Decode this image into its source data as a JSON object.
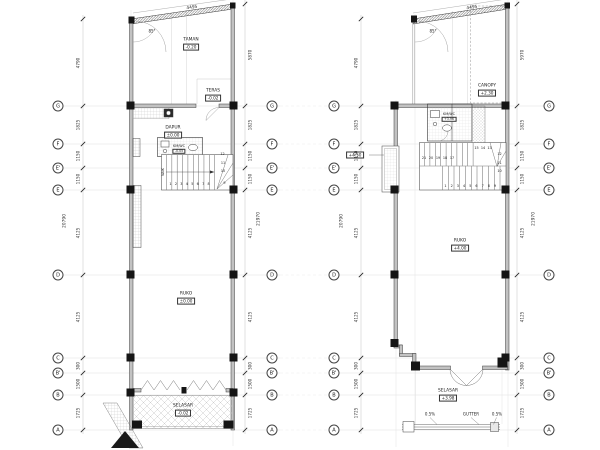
{
  "drawing": {
    "grid_letters": [
      "G",
      "F",
      "E'",
      "E",
      "D",
      "C",
      "B'",
      "B",
      "A"
    ],
    "plans": [
      {
        "name": "lower-floor-plan",
        "rooms": {
          "taman": {
            "name": "TAMAN",
            "level": "-0.20"
          },
          "teras": {
            "name": "TERAS",
            "level": "-0.02"
          },
          "dapur": {
            "name": "DAPUR",
            "level": "±0.00"
          },
          "kmwc": {
            "name": "KM/WC",
            "level": "-0.05"
          },
          "ruko": {
            "name": "RUKO",
            "level": "±0.00"
          },
          "selasar": {
            "name": "SELASAR",
            "level": "-0.02"
          }
        },
        "stairs": {
          "run1": [
            "1",
            "2",
            "3",
            "4",
            "5",
            "6",
            "7",
            "8"
          ],
          "winder": [
            "9",
            "10",
            "11",
            "12"
          ],
          "note": "NAIK"
        },
        "dims": {
          "left": [
            "4790",
            "1825",
            "1150",
            "1150",
            "4125",
            "4125",
            "300",
            "1500",
            "1725"
          ],
          "left_total": "20790",
          "right": [
            "5870",
            "1825",
            "1150",
            "1150",
            "4125",
            "4125",
            "300",
            "1500",
            "1725"
          ],
          "right_total": "21970",
          "top": "4495",
          "angle": "85°"
        }
      },
      {
        "name": "upper-floor-plan",
        "rooms": {
          "canopy": {
            "name": "CANOPY",
            "level": "+2.30"
          },
          "kmwc": {
            "name": "KM/WC",
            "level": "+3.96"
          },
          "ruko": {
            "name": "RUKO",
            "level": "+4.00"
          },
          "selasar": {
            "name": "SELASAR",
            "level": "+3.98"
          }
        },
        "annotations": {
          "planter_level": "+4.50",
          "gutter": "GUTTER",
          "slope_left": "0.5%",
          "slope_right": "0.5%"
        },
        "stairs": {
          "run1": [
            "1",
            "2",
            "3",
            "4",
            "5",
            "6",
            "7",
            "8",
            "9"
          ],
          "winder": [
            "10",
            "11",
            "12",
            "13",
            "14",
            "15"
          ],
          "run2": [
            "21",
            "20",
            "19",
            "18",
            "17"
          ]
        },
        "dims": {
          "left": [
            "4790",
            "1825",
            "1150",
            "1150",
            "4125",
            "4125",
            "300",
            "1500",
            "1725"
          ],
          "left_total": "20790",
          "right": [
            "5970",
            "1825",
            "1150",
            "1150",
            "4125",
            "4125",
            "300",
            "1500",
            "1725"
          ],
          "right_total": "21970",
          "top": "4495",
          "angle": "85°"
        }
      }
    ]
  }
}
